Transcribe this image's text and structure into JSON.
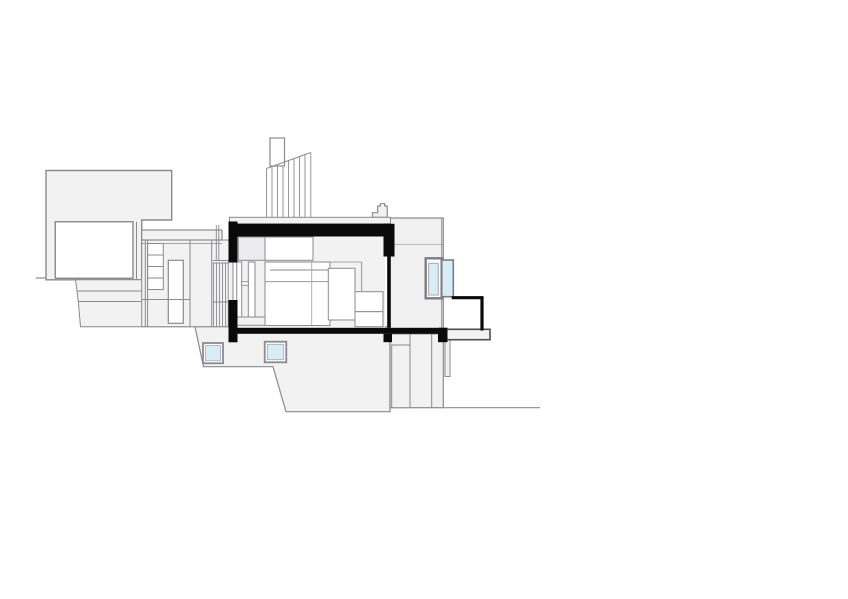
{
  "page": {
    "title": "Architectural section drawing",
    "description": "Black-and-white architectural cross-section of a multi-level hillside house with light blue window glazing",
    "background": "#ffffff",
    "width": 848,
    "height": 599
  },
  "drawing": {
    "palette": {
      "light": "#f2f2f3",
      "white": "#ffffff",
      "panel": "#ececee",
      "rv": "#f0f0f1",
      "stroke": "#8a8a8f",
      "stroke_light": "#a8a8ad",
      "stroke_dark": "#4d4d52",
      "frame": "#7c7c82",
      "black": "#0a0a0a",
      "blue": "#d8edf6",
      "none": "none"
    },
    "shapes": [
      {
        "name": "ground-line-left",
        "type": "line",
        "x1": 36,
        "y1": 278,
        "x2": 46,
        "y2": 278,
        "stroke": "stroke",
        "sw": 1.2
      },
      {
        "name": "left-house-body",
        "type": "polygon",
        "points": "46,170.5 171.7,170.5 171.7,220 141.7,220 141.7,279.8 46,279.8",
        "fill": "light",
        "stroke": "stroke",
        "sw": 1.4
      },
      {
        "name": "left-house-window",
        "type": "rect",
        "x": 55.3,
        "y": 221.7,
        "w": 77.7,
        "h": 56.6,
        "fill": "white",
        "stroke": "stroke",
        "sw": 1.4
      },
      {
        "name": "left-house-mullion",
        "type": "line",
        "x1": 136.5,
        "y1": 221.7,
        "x2": 136.5,
        "y2": 279.8,
        "stroke": "stroke",
        "sw": 1
      },
      {
        "name": "terrace-band-1",
        "type": "polygon",
        "points": "75.5,279.8 143,279.8 143,291 77,291",
        "fill": "light",
        "stroke": "stroke",
        "sw": 1
      },
      {
        "name": "terrace-band-2",
        "type": "polygon",
        "points": "77,291 143,291 143,301.5 78.3,301.5",
        "fill": "light",
        "stroke": "stroke",
        "sw": 1
      },
      {
        "name": "terrace-ground",
        "type": "polygon",
        "points": "78.3,301.5 196,301.5 195,326.7 80.5,326.7",
        "fill": "light",
        "stroke": "stroke",
        "sw": 1
      },
      {
        "name": "basement-body",
        "type": "polygon",
        "points": "195,326.7 390,326.7 390,411.7 286,411.7 273,366.7 203.5,366.7",
        "fill": "light",
        "stroke": "stroke",
        "sw": 1.2
      },
      {
        "name": "basement-right-body",
        "type": "rect",
        "x": 390,
        "y": 333.8,
        "w": 53.3,
        "h": 73.9,
        "fill": "light",
        "stroke": "stroke",
        "sw": 1.2
      },
      {
        "name": "basement-right-joint-1",
        "type": "line",
        "x1": 410,
        "y1": 333.8,
        "x2": 410,
        "y2": 407.7,
        "stroke": "stroke",
        "sw": 1
      },
      {
        "name": "basement-right-joint-2",
        "type": "line",
        "x1": 431.7,
        "y1": 333.8,
        "x2": 431.7,
        "y2": 407.7,
        "stroke": "stroke",
        "sw": 1
      },
      {
        "name": "basement-door",
        "type": "rect",
        "x": 391.7,
        "y": 345,
        "w": 18.3,
        "h": 62.7,
        "fill": "light",
        "stroke": "stroke",
        "sw": 1
      },
      {
        "name": "ground-line-right",
        "type": "line",
        "x1": 443.3,
        "y1": 407.7,
        "x2": 540,
        "y2": 407.7,
        "stroke": "stroke",
        "sw": 1.2
      },
      {
        "name": "downpipe-strip",
        "type": "rect",
        "x": 445,
        "y": 339.5,
        "w": 5,
        "h": 37,
        "fill": "light",
        "stroke": "stroke",
        "sw": 1
      },
      {
        "name": "porch-bg",
        "type": "rect",
        "x": 141.7,
        "y": 240,
        "w": 91.3,
        "h": 86.7,
        "fill": "light",
        "stroke": "stroke",
        "sw": 1
      },
      {
        "name": "porch-beam",
        "type": "rect",
        "x": 141.7,
        "y": 230,
        "w": 80.3,
        "h": 10,
        "fill": "light",
        "stroke": "stroke",
        "sw": 1.2
      },
      {
        "name": "porch-beam-underline",
        "type": "line",
        "x1": 141.7,
        "y1": 243.5,
        "x2": 222,
        "y2": 243.5,
        "stroke": "stroke",
        "sw": 0.8
      },
      {
        "name": "stair-ladder-box",
        "type": "rect",
        "x": 147.6,
        "y": 243.5,
        "w": 15.7,
        "h": 46,
        "fill": "white",
        "stroke": "stroke",
        "sw": 1
      },
      {
        "name": "stair-rung-1",
        "type": "line",
        "x1": 147.6,
        "y1": 255,
        "x2": 163.3,
        "y2": 255,
        "stroke": "stroke",
        "sw": 1
      },
      {
        "name": "stair-rung-2",
        "type": "line",
        "x1": 147.6,
        "y1": 266.5,
        "x2": 163.3,
        "y2": 266.5,
        "stroke": "stroke",
        "sw": 1
      },
      {
        "name": "stair-rung-3",
        "type": "line",
        "x1": 147.6,
        "y1": 278,
        "x2": 163.3,
        "y2": 278,
        "stroke": "stroke",
        "sw": 1
      },
      {
        "name": "stair-rail-1",
        "type": "line",
        "x1": 145.3,
        "y1": 240,
        "x2": 145.3,
        "y2": 326.7,
        "stroke": "stroke",
        "sw": 1
      },
      {
        "name": "stair-rail-2",
        "type": "line",
        "x1": 147.6,
        "y1": 240,
        "x2": 147.6,
        "y2": 326.7,
        "stroke": "stroke",
        "sw": 1
      },
      {
        "name": "porch-door",
        "type": "rect",
        "x": 168.3,
        "y": 260.3,
        "w": 15,
        "h": 63,
        "fill": "white",
        "stroke": "stroke",
        "sw": 1.2
      },
      {
        "name": "porch-post-1",
        "type": "line",
        "x1": 190,
        "y1": 240,
        "x2": 190,
        "y2": 326.7,
        "stroke": "stroke",
        "sw": 1
      },
      {
        "name": "porch-post-2",
        "type": "line",
        "x1": 211.7,
        "y1": 240,
        "x2": 211.7,
        "y2": 326.7,
        "stroke": "stroke",
        "sw": 1
      },
      {
        "name": "porch-floor-line",
        "type": "line",
        "x1": 141.7,
        "y1": 299.5,
        "x2": 190,
        "y2": 299.5,
        "stroke": "stroke",
        "sw": 1
      },
      {
        "name": "louver-sill-top",
        "type": "line",
        "x1": 212.7,
        "y1": 260.5,
        "x2": 229,
        "y2": 260.5,
        "stroke": "stroke",
        "sw": 1
      },
      {
        "name": "louver-sill-bottom",
        "type": "line",
        "x1": 212.7,
        "y1": 263,
        "x2": 229,
        "y2": 263,
        "stroke": "stroke",
        "sw": 1
      },
      {
        "name": "louver-mid-line",
        "type": "line",
        "x1": 212.7,
        "y1": 302,
        "x2": 229,
        "y2": 302,
        "stroke": "stroke",
        "sw": 1
      },
      {
        "name": "louver-slat-1",
        "type": "line",
        "x1": 213.5,
        "y1": 263,
        "x2": 213.5,
        "y2": 326.7,
        "stroke": "stroke",
        "sw": 0.9
      },
      {
        "name": "louver-slat-2",
        "type": "line",
        "x1": 216.5,
        "y1": 263,
        "x2": 216.5,
        "y2": 326.7,
        "stroke": "stroke",
        "sw": 0.9
      },
      {
        "name": "louver-slat-3",
        "type": "line",
        "x1": 219.5,
        "y1": 263,
        "x2": 219.5,
        "y2": 326.7,
        "stroke": "stroke",
        "sw": 0.9
      },
      {
        "name": "louver-slat-4",
        "type": "line",
        "x1": 222.5,
        "y1": 263,
        "x2": 222.5,
        "y2": 326.7,
        "stroke": "stroke",
        "sw": 0.9
      },
      {
        "name": "louver-slat-5",
        "type": "line",
        "x1": 225.5,
        "y1": 263,
        "x2": 225.5,
        "y2": 326.7,
        "stroke": "stroke",
        "sw": 0.9
      },
      {
        "name": "louver-slat-6",
        "type": "line",
        "x1": 228.2,
        "y1": 263,
        "x2": 228.2,
        "y2": 326.7,
        "stroke": "stroke",
        "sw": 0.9
      },
      {
        "name": "wall-pipe-1",
        "type": "line",
        "x1": 216.3,
        "y1": 225,
        "x2": 216.3,
        "y2": 260,
        "stroke": "stroke",
        "sw": 0.9
      },
      {
        "name": "wall-pipe-2",
        "type": "line",
        "x1": 218.8,
        "y1": 225,
        "x2": 218.8,
        "y2": 260,
        "stroke": "stroke",
        "sw": 0.9
      },
      {
        "name": "room-bg",
        "type": "rect",
        "x": 237.5,
        "y": 236.5,
        "w": 147.5,
        "h": 91.3,
        "fill": "light",
        "stroke": "none",
        "sw": 0
      },
      {
        "name": "room-shelf-panel",
        "type": "rect",
        "x": 238.3,
        "y": 237,
        "w": 26.7,
        "h": 23.3,
        "fill": "panel",
        "stroke": "stroke",
        "sw": 1
      },
      {
        "name": "room-cabinet-top",
        "type": "rect",
        "x": 265,
        "y": 237,
        "w": 48,
        "h": 23.3,
        "fill": "white",
        "stroke": "stroke",
        "sw": 1
      },
      {
        "name": "room-shelf-line",
        "type": "line",
        "x1": 313,
        "y1": 262,
        "x2": 361.7,
        "y2": 262,
        "stroke": "stroke_light",
        "sw": 0.9
      },
      {
        "name": "room-upright-1",
        "type": "rect",
        "x": 236.7,
        "y": 262,
        "w": 5,
        "h": 55,
        "fill": "white",
        "stroke": "stroke",
        "sw": 1
      },
      {
        "name": "room-upright-2",
        "type": "rect",
        "x": 248.3,
        "y": 262,
        "w": 6.7,
        "h": 55,
        "fill": "white",
        "stroke": "stroke",
        "sw": 1
      },
      {
        "name": "room-upright-tie",
        "type": "rect",
        "x": 241.7,
        "y": 281.7,
        "w": 6.6,
        "h": 3.6,
        "fill": "white",
        "stroke": "stroke",
        "sw": 0.9
      },
      {
        "name": "room-plinth",
        "type": "rect",
        "x": 236.7,
        "y": 317,
        "w": 28.3,
        "h": 8.3,
        "fill": "light",
        "stroke": "stroke",
        "sw": 1
      },
      {
        "name": "room-bed",
        "type": "rect",
        "x": 265,
        "y": 262,
        "w": 65,
        "h": 63.5,
        "fill": "white",
        "stroke": "stroke",
        "sw": 1
      },
      {
        "name": "room-bed-line-1",
        "type": "line",
        "x1": 270,
        "y1": 270,
        "x2": 330,
        "y2": 270,
        "stroke": "stroke",
        "sw": 0.9
      },
      {
        "name": "room-bed-line-2",
        "type": "line",
        "x1": 265,
        "y1": 281.7,
        "x2": 330,
        "y2": 281.7,
        "stroke": "stroke",
        "sw": 0.9
      },
      {
        "name": "room-divider-line",
        "type": "line",
        "x1": 311.7,
        "y1": 260.5,
        "x2": 311.7,
        "y2": 325.5,
        "stroke": "stroke_light",
        "sw": 0.9
      },
      {
        "name": "room-wardrobe",
        "type": "rect",
        "x": 328.3,
        "y": 268.3,
        "w": 26.7,
        "h": 51.7,
        "fill": "white",
        "stroke": "stroke",
        "sw": 1
      },
      {
        "name": "room-partition-line",
        "type": "line",
        "x1": 361.7,
        "y1": 262,
        "x2": 361.7,
        "y2": 291.7,
        "stroke": "stroke",
        "sw": 0.9
      },
      {
        "name": "room-desk-upper",
        "type": "rect",
        "x": 355,
        "y": 291.7,
        "w": 28,
        "h": 20,
        "fill": "white",
        "stroke": "stroke",
        "sw": 1
      },
      {
        "name": "room-desk-lower",
        "type": "rect",
        "x": 355,
        "y": 311.7,
        "w": 28,
        "h": 15,
        "fill": "white",
        "stroke": "stroke",
        "sw": 1
      },
      {
        "name": "roof-fence-slat-1",
        "type": "line",
        "x1": 266.5,
        "y1": 168.5,
        "x2": 266.5,
        "y2": 217.3,
        "stroke": "stroke",
        "sw": 0.9
      },
      {
        "name": "roof-fence-slat-2",
        "type": "line",
        "x1": 272,
        "y1": 166.5,
        "x2": 272,
        "y2": 217.3,
        "stroke": "stroke",
        "sw": 0.9
      },
      {
        "name": "roof-fence-slat-3",
        "type": "line",
        "x1": 277.5,
        "y1": 164.5,
        "x2": 277.5,
        "y2": 217.3,
        "stroke": "stroke",
        "sw": 0.9
      },
      {
        "name": "roof-fence-slat-4",
        "type": "line",
        "x1": 283,
        "y1": 162.5,
        "x2": 283,
        "y2": 217.3,
        "stroke": "stroke",
        "sw": 0.9
      },
      {
        "name": "roof-fence-slat-5",
        "type": "line",
        "x1": 288.5,
        "y1": 160.6,
        "x2": 288.5,
        "y2": 217.3,
        "stroke": "stroke",
        "sw": 0.9
      },
      {
        "name": "roof-fence-slat-6",
        "type": "line",
        "x1": 294,
        "y1": 158.6,
        "x2": 294,
        "y2": 217.3,
        "stroke": "stroke",
        "sw": 0.9
      },
      {
        "name": "roof-fence-slat-7",
        "type": "line",
        "x1": 299.5,
        "y1": 156.6,
        "x2": 299.5,
        "y2": 217.3,
        "stroke": "stroke",
        "sw": 0.9
      },
      {
        "name": "roof-fence-slat-8",
        "type": "line",
        "x1": 305,
        "y1": 154.6,
        "x2": 305,
        "y2": 217.3,
        "stroke": "stroke",
        "sw": 0.9
      },
      {
        "name": "roof-fence-slat-9",
        "type": "line",
        "x1": 310.8,
        "y1": 152.5,
        "x2": 310.8,
        "y2": 217.3,
        "stroke": "stroke",
        "sw": 0.9
      },
      {
        "name": "roof-chimney",
        "type": "rect",
        "x": 270,
        "y": 138,
        "w": 14.5,
        "h": 28,
        "fill": "white",
        "stroke": "stroke",
        "sw": 1.2
      },
      {
        "name": "roof-fence-slope",
        "type": "line",
        "x1": 266.5,
        "y1": 168.5,
        "x2": 310.8,
        "y2": 152.5,
        "stroke": "stroke",
        "sw": 1
      },
      {
        "name": "small-chimney",
        "type": "polygon",
        "points": "372.5,217.3 372.5,212.7 377.7,212.7 377.7,206 380.3,206 380.3,203.7 384.7,203.7 384.7,206 387.3,206 387.3,217.3",
        "fill": "light",
        "stroke": "stroke",
        "sw": 1.2
      },
      {
        "name": "right-volume-body",
        "type": "rect",
        "x": 389,
        "y": 218,
        "w": 54.3,
        "h": 115.8,
        "fill": "rv",
        "stroke": "stroke",
        "sw": 1.2
      },
      {
        "name": "right-volume-line",
        "type": "line",
        "x1": 389,
        "y1": 244.5,
        "x2": 443.3,
        "y2": 244.5,
        "stroke": "stroke_light",
        "sw": 0.8
      },
      {
        "name": "right-facade-line",
        "type": "line",
        "x1": 441.7,
        "y1": 218,
        "x2": 441.7,
        "y2": 329,
        "stroke": "stroke",
        "sw": 0.9
      },
      {
        "name": "roof-parapet",
        "type": "rect",
        "x": 229.5,
        "y": 217.3,
        "w": 161,
        "h": 6.5,
        "fill": "light",
        "stroke": "stroke",
        "sw": 1
      },
      {
        "name": "bay-window-frame",
        "type": "rect",
        "x": 425.7,
        "y": 258.3,
        "w": 16,
        "h": 40,
        "fill": "white",
        "stroke": "frame",
        "sw": 2.4
      },
      {
        "name": "bay-window-glass",
        "type": "rect",
        "x": 428.6,
        "y": 263.3,
        "w": 9.7,
        "h": 31.7,
        "fill": "blue",
        "stroke": "stroke_light",
        "sw": 1
      },
      {
        "name": "bay-pane-outer",
        "type": "rect",
        "x": 441.7,
        "y": 260,
        "w": 11.6,
        "h": 36.7,
        "fill": "blue",
        "stroke": "frame",
        "sw": 1.6
      },
      {
        "name": "balcony-slab",
        "type": "rect",
        "x": 446.7,
        "y": 329.3,
        "w": 43.3,
        "h": 10.4,
        "fill": "light",
        "stroke": "stroke_dark",
        "sw": 1.6
      },
      {
        "name": "balcony-balustrade",
        "type": "polyline",
        "points": "451.7,297.7 482,297.7 482,330.5",
        "fill": "none",
        "stroke": "black",
        "sw": 3.2
      },
      {
        "name": "roof-slab-cut",
        "type": "rect",
        "x": 228.5,
        "y": 223.8,
        "w": 162.5,
        "h": 12.7,
        "fill": "black",
        "stroke": "none",
        "sw": 0
      },
      {
        "name": "left-wall-upper-cut",
        "type": "rect",
        "x": 228.5,
        "y": 221.5,
        "w": 9,
        "h": 41,
        "fill": "black",
        "stroke": "none",
        "sw": 0
      },
      {
        "name": "left-wall-lower-cut",
        "type": "rect",
        "x": 228.5,
        "y": 300,
        "w": 9,
        "h": 42.3,
        "fill": "black",
        "stroke": "none",
        "sw": 0
      },
      {
        "name": "right-wall-upper-cut",
        "type": "rect",
        "x": 383.5,
        "y": 223.8,
        "w": 11,
        "h": 32.7,
        "fill": "black",
        "stroke": "none",
        "sw": 0
      },
      {
        "name": "right-wall-thin-cut",
        "type": "rect",
        "x": 387.2,
        "y": 256.5,
        "w": 3.6,
        "h": 71.3,
        "fill": "black",
        "stroke": "none",
        "sw": 0
      },
      {
        "name": "floor-slab-cut",
        "type": "rect",
        "x": 233,
        "y": 327.8,
        "w": 214.5,
        "h": 6,
        "fill": "black",
        "stroke": "none",
        "sw": 0
      },
      {
        "name": "right-wall-stub-cut",
        "type": "rect",
        "x": 383.5,
        "y": 333.8,
        "w": 8.5,
        "h": 8.4,
        "fill": "black",
        "stroke": "none",
        "sw": 0
      },
      {
        "name": "balcony-wall-stub-cut",
        "type": "rect",
        "x": 438,
        "y": 327.8,
        "w": 9.5,
        "h": 14.4,
        "fill": "black",
        "stroke": "none",
        "sw": 0
      },
      {
        "name": "basement-window-1-frame",
        "type": "rect",
        "x": 203,
        "y": 343,
        "w": 20,
        "h": 20.3,
        "fill": "white",
        "stroke": "stroke",
        "sw": 1.8
      },
      {
        "name": "basement-window-1-glass",
        "type": "rect",
        "x": 205.5,
        "y": 345.5,
        "w": 15,
        "h": 15.3,
        "fill": "blue",
        "stroke": "stroke_light",
        "sw": 0.8
      },
      {
        "name": "basement-window-2-frame",
        "type": "rect",
        "x": 264.7,
        "y": 341.7,
        "w": 21.6,
        "h": 20.6,
        "fill": "white",
        "stroke": "stroke",
        "sw": 1.8
      },
      {
        "name": "basement-window-2-glass",
        "type": "rect",
        "x": 267.3,
        "y": 344.3,
        "w": 16.4,
        "h": 15.4,
        "fill": "blue",
        "stroke": "stroke_light",
        "sw": 0.8
      }
    ]
  }
}
